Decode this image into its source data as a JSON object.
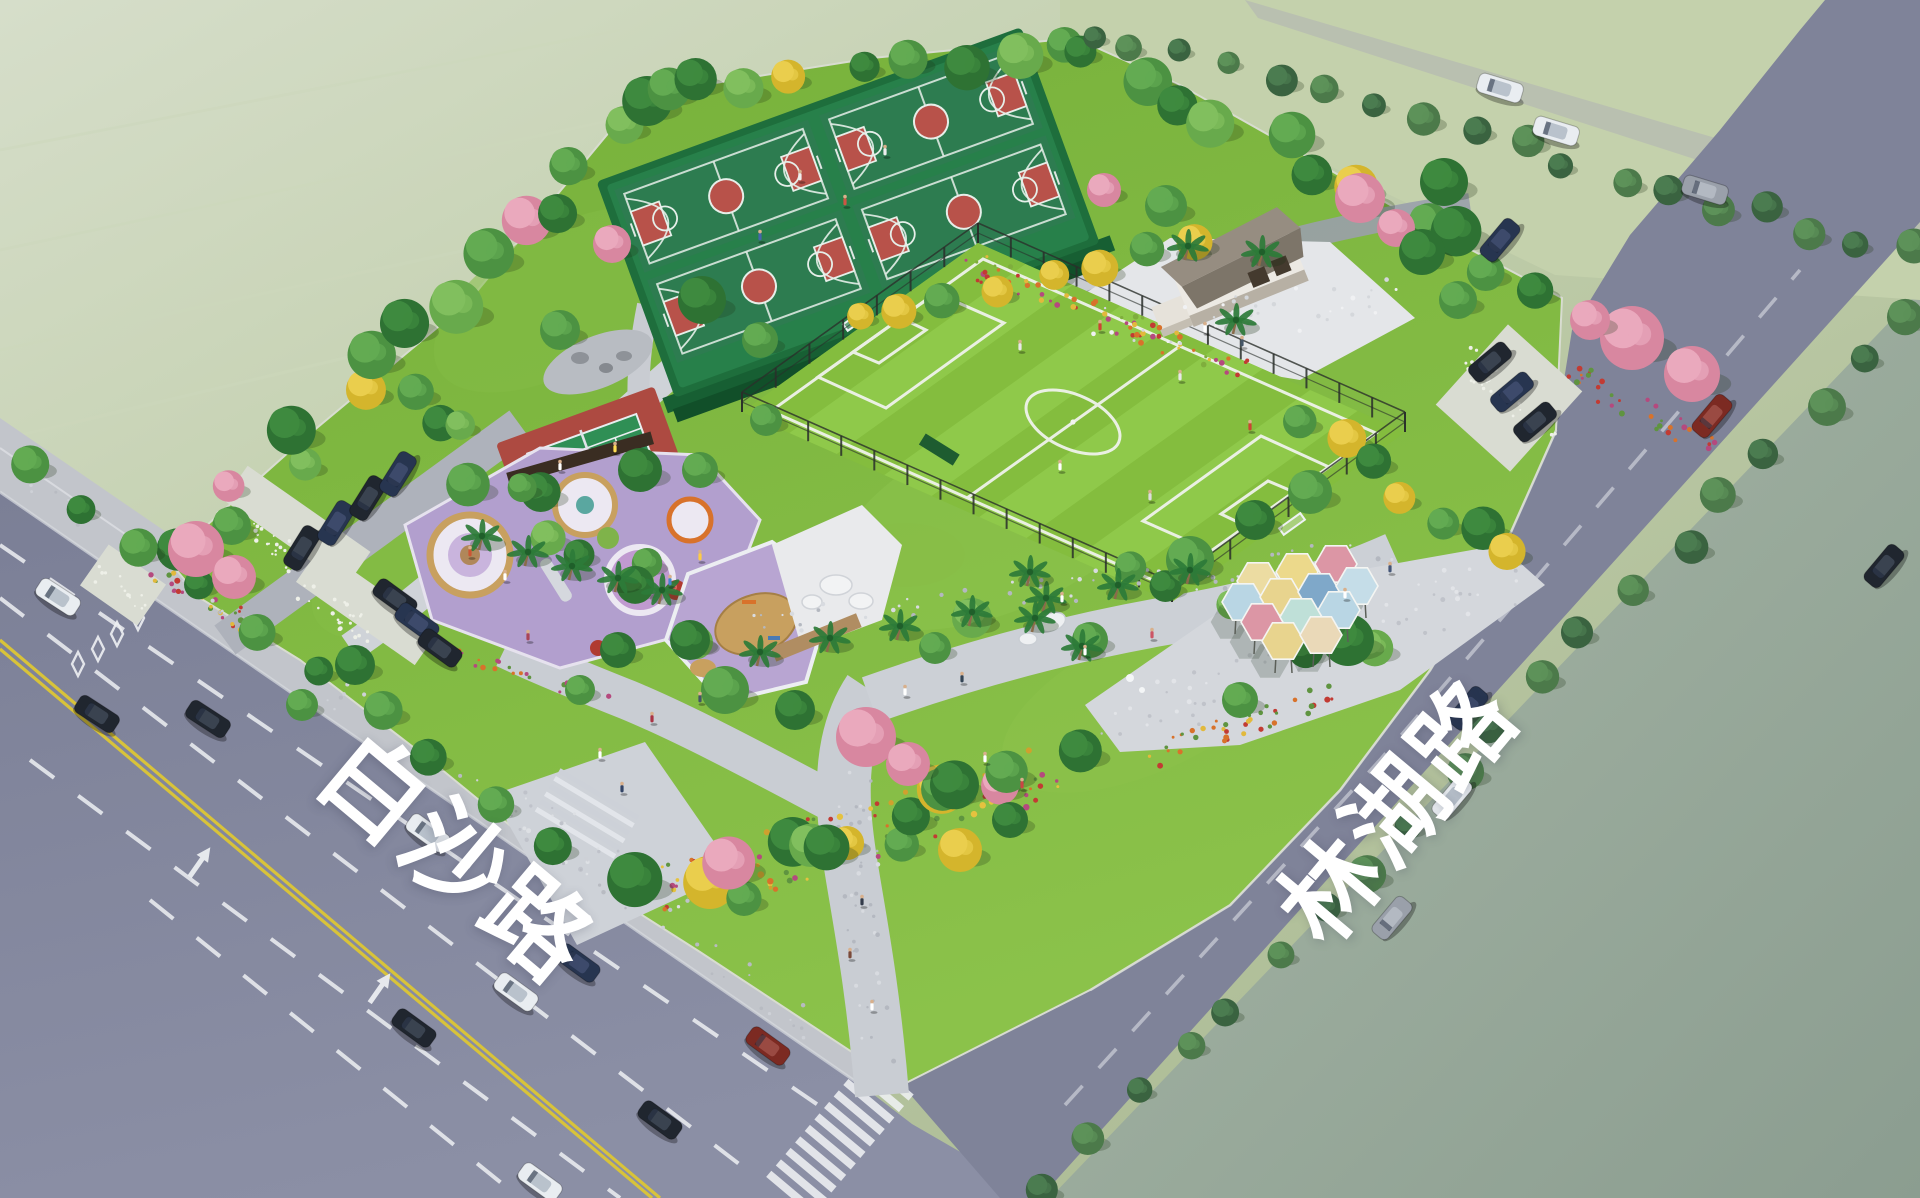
{
  "meta": {
    "type": "aerial-landscape-render",
    "subject": "community sports park at the corner of two roads",
    "canvas": {
      "w": 1920,
      "h": 1198
    }
  },
  "labels": {
    "road_bottom": "白沙路",
    "road_right": "林湖路",
    "text_color": "#ffffff"
  },
  "palette": {
    "road": "#7e8299",
    "road_light": "#8d91a6",
    "sidewalk": "#c2c5cb",
    "park_lawn": "#7cb43e",
    "lawn_light": "#8dc44e",
    "football_green": "#84bd3e",
    "football_stripe": "#90c94b",
    "court_green": "#2d7c50",
    "court_red": "#b8524a",
    "tennis_red": "#ad4a41",
    "tennis_green": "#2f8f55",
    "path_gray": "#c9cdd3",
    "plaza_white": "#e4e6e9",
    "play_purple": "#b29fce",
    "sand_tan": "#c8a05f",
    "hedge_dark": "#1e6e3c",
    "haze_field": "#c2cfad",
    "river": "#93a496",
    "marking_white": "#eef0f3",
    "marking_yellow": "#d8c33a"
  },
  "facilities": {
    "basketball_courts": 4,
    "tennis_courts": 1,
    "football_fields": 1,
    "children_playground": 1,
    "sand_play_area": 1,
    "hexagon_canopy_plaza": 1,
    "pavilion_buildings": 1,
    "parking_clusters": 2,
    "zebra_crossings": 1
  },
  "hex_canopies": {
    "cx": 1290,
    "cy": 610,
    "r": 21,
    "items": [
      {
        "dx": -32,
        "dy": -29,
        "c": "#ecdca2"
      },
      {
        "dx": 7,
        "dy": -38,
        "c": "#ecd98b"
      },
      {
        "dx": 46,
        "dy": -46,
        "c": "#dc96a5"
      },
      {
        "dx": -47,
        "dy": -8,
        "c": "#b9d6e4"
      },
      {
        "dx": -9,
        "dy": -13,
        "c": "#e8d48e"
      },
      {
        "dx": 29,
        "dy": -18,
        "c": "#7fa8c9"
      },
      {
        "dx": 67,
        "dy": -24,
        "c": "#c5dde8"
      },
      {
        "dx": -28,
        "dy": 12,
        "c": "#dc96a5"
      },
      {
        "dx": 11,
        "dy": 7,
        "c": "#bfe0d8"
      },
      {
        "dx": 49,
        "dy": 0,
        "c": "#b9d6e4"
      },
      {
        "dx": -7,
        "dy": 31,
        "c": "#e8d48e"
      },
      {
        "dx": 31,
        "dy": 25,
        "c": "#ead9b8"
      }
    ]
  },
  "football_corners": {
    "N": [
      978,
      243
    ],
    "E": [
      1405,
      432
    ],
    "S": [
      1172,
      602
    ],
    "W": [
      742,
      412
    ],
    "stripes": 9
  },
  "fence_edges": [
    [
      742,
      412,
      1172,
      602,
      13
    ],
    [
      1172,
      602,
      1405,
      432,
      8
    ],
    [
      978,
      243,
      1405,
      432,
      13
    ],
    [
      742,
      412,
      978,
      243,
      7
    ]
  ],
  "tree_belts": [
    {
      "x1": 185,
      "y1": 555,
      "x2": 635,
      "y2": 105,
      "n": 15,
      "w": 48,
      "rmin": 15,
      "rmax": 27,
      "types": [
        "g_dark",
        "g_mid",
        "pink",
        "g_light",
        "g_dark",
        "yellow",
        "g_mid",
        "g_dark",
        "g_light",
        "g_mid",
        "pink",
        "g_dark",
        "g_mid",
        "g_light",
        "g_dark"
      ]
    },
    {
      "x1": 650,
      "y1": 100,
      "x2": 1070,
      "y2": 45,
      "n": 9,
      "w": 40,
      "rmin": 15,
      "rmax": 24,
      "types": [
        "g_mid",
        "g_dark",
        "g_light",
        "yellow",
        "g_dark",
        "g_mid",
        "g_dark",
        "g_light",
        "g_mid"
      ]
    },
    {
      "x1": 1085,
      "y1": 50,
      "x2": 1550,
      "y2": 292,
      "n": 11,
      "w": 46,
      "rmin": 15,
      "rmax": 26,
      "types": [
        "g_dark",
        "g_mid",
        "g_dark",
        "g_light",
        "g_mid",
        "g_dark",
        "yellow",
        "g_mid",
        "g_dark",
        "g_mid",
        "g_dark"
      ]
    },
    {
      "x1": 1048,
      "y1": 1190,
      "x2": 1905,
      "y2": 318,
      "n": 20,
      "w": 26,
      "rmin": 12,
      "rmax": 19,
      "types": [
        "street",
        "street_l"
      ]
    },
    {
      "x1": 1090,
      "y1": 30,
      "x2": 1910,
      "y2": 255,
      "n": 18,
      "w": 26,
      "rmin": 11,
      "rmax": 18,
      "types": [
        "street",
        "street_l"
      ]
    },
    {
      "x1": 30,
      "y1": 462,
      "x2": 552,
      "y2": 842,
      "n": 10,
      "w": 16,
      "rmin": 14,
      "rmax": 20,
      "types": [
        "g_mid",
        "g_dark"
      ]
    },
    {
      "x1": 858,
      "y1": 322,
      "x2": 1185,
      "y2": 240,
      "n": 8,
      "w": 20,
      "rmin": 13,
      "rmax": 19,
      "types": [
        "yellow",
        "yellow",
        "g_mid",
        "yellow"
      ]
    },
    {
      "x1": 1290,
      "y1": 428,
      "x2": 1525,
      "y2": 556,
      "n": 7,
      "w": 36,
      "rmin": 14,
      "rmax": 22,
      "types": [
        "g_mid",
        "yellow",
        "g_dark",
        "yellow",
        "g_mid",
        "g_dark",
        "yellow"
      ]
    },
    {
      "x1": 665,
      "y1": 898,
      "x2": 1060,
      "y2": 762,
      "n": 16,
      "w": 62,
      "rmin": 15,
      "rmax": 28,
      "types": [
        "g_dark",
        "yellow",
        "g_mid",
        "pink",
        "g_dark",
        "g_light",
        "yellow",
        "g_dark",
        "g_mid",
        "g_dark",
        "yellow",
        "g_mid",
        "g_dark",
        "pink",
        "g_mid",
        "g_dark"
      ]
    },
    {
      "x1": 400,
      "y1": 395,
      "x2": 680,
      "y2": 620,
      "n": 11,
      "w": 64,
      "rmin": 14,
      "rmax": 24,
      "types": [
        "g_mid",
        "g_dark",
        "g_light",
        "g_mid",
        "g_dark",
        "g_mid",
        "g_light",
        "g_dark",
        "g_mid",
        "g_dark",
        "g_light"
      ]
    },
    {
      "x1": 1110,
      "y1": 565,
      "x2": 1360,
      "y2": 655,
      "n": 6,
      "w": 44,
      "rmin": 14,
      "rmax": 22,
      "types": [
        "g_mid",
        "g_dark",
        "g_light"
      ]
    }
  ],
  "tree_singles": [
    [
      196,
      549,
      28,
      "pink"
    ],
    [
      234,
      577,
      22,
      "pink"
    ],
    [
      1632,
      338,
      32,
      "pink"
    ],
    [
      1692,
      374,
      28,
      "pink"
    ],
    [
      1590,
      320,
      20,
      "pink"
    ],
    [
      866,
      737,
      30,
      "pink"
    ],
    [
      908,
      764,
      22,
      "pink"
    ],
    [
      612,
      244,
      19,
      "pink"
    ],
    [
      1360,
      198,
      25,
      "pink"
    ],
    [
      1396,
      228,
      19,
      "pink"
    ],
    [
      1104,
      190,
      17,
      "pink"
    ],
    [
      1166,
      206,
      21,
      "g_mid"
    ],
    [
      1422,
      252,
      23,
      "g_dark"
    ],
    [
      1458,
      300,
      19,
      "g_mid"
    ],
    [
      1444,
      182,
      24,
      "g_dark"
    ],
    [
      702,
      300,
      24,
      "g_dark"
    ],
    [
      760,
      340,
      18,
      "g_mid"
    ],
    [
      560,
      330,
      20,
      "g_mid"
    ],
    [
      640,
      470,
      22,
      "g_dark"
    ],
    [
      700,
      470,
      18,
      "g_mid"
    ],
    [
      355,
      665,
      20,
      "g_dark"
    ],
    [
      302,
      705,
      16,
      "g_mid"
    ],
    [
      1190,
      560,
      24,
      "g_mid"
    ],
    [
      1255,
      520,
      20,
      "g_dark"
    ],
    [
      1310,
      492,
      22,
      "g_mid"
    ],
    [
      1348,
      640,
      26,
      "g_dark"
    ],
    [
      1240,
      700,
      18,
      "g_mid"
    ],
    [
      972,
      618,
      20,
      "g_light"
    ],
    [
      935,
      648,
      16,
      "g_mid"
    ],
    [
      618,
      650,
      18,
      "g_dark"
    ],
    [
      580,
      690,
      15,
      "g_mid"
    ],
    [
      766,
      420,
      16,
      "g_mid"
    ],
    [
      690,
      640,
      20,
      "g_dark"
    ],
    [
      725,
      690,
      24,
      "g_mid"
    ],
    [
      795,
      710,
      20,
      "g_dark"
    ],
    [
      960,
      850,
      22,
      "yellow"
    ],
    [
      1010,
      820,
      18,
      "g_dark"
    ],
    [
      1090,
      640,
      18,
      "g_mid"
    ]
  ],
  "palms": [
    [
      482,
      536
    ],
    [
      528,
      552
    ],
    [
      572,
      566
    ],
    [
      618,
      578
    ],
    [
      662,
      590
    ],
    [
      760,
      652
    ],
    [
      830,
      638
    ],
    [
      900,
      626
    ],
    [
      972,
      612
    ],
    [
      1046,
      598
    ],
    [
      1118,
      585
    ],
    [
      1190,
      570
    ],
    [
      1188,
      246
    ],
    [
      1262,
      252
    ],
    [
      1236,
      320
    ],
    [
      1035,
      618
    ],
    [
      1082,
      646
    ],
    [
      1030,
      572
    ]
  ],
  "cars": {
    "colors": {
      "white": "#e9edf1",
      "black": "#20262f",
      "navy": "#273550",
      "gray": "#9aa0aa",
      "darkred": "#7c2a22"
    },
    "cabins": {
      "white": "#b9c2cc",
      "black": "#3a4350",
      "navy": "#3d4a6b",
      "gray": "#b3b9c2",
      "darkred": "#9a4a42"
    },
    "items": [
      [
        428,
        833,
        36,
        "white"
      ],
      [
        578,
        963,
        36,
        "navy"
      ],
      [
        516,
        992,
        36,
        "white"
      ],
      [
        414,
        1028,
        36,
        "black"
      ],
      [
        97,
        714,
        33,
        "black"
      ],
      [
        208,
        719,
        33,
        "black"
      ],
      [
        58,
        597,
        33,
        "white"
      ],
      [
        768,
        1046,
        36,
        "darkred"
      ],
      [
        660,
        1120,
        36,
        "black"
      ],
      [
        540,
        1182,
        36,
        "white"
      ],
      [
        1468,
        708,
        -50,
        "navy"
      ],
      [
        1452,
        798,
        -50,
        "white"
      ],
      [
        1392,
        918,
        -50,
        "gray"
      ],
      [
        1712,
        416,
        -50,
        "darkred"
      ],
      [
        1500,
        240,
        -50,
        "navy"
      ],
      [
        1884,
        566,
        -50,
        "black"
      ],
      [
        1500,
        88,
        17,
        "white"
      ],
      [
        1556,
        131,
        17,
        "white"
      ],
      [
        1705,
        190,
        17,
        "gray"
      ],
      [
        302,
        548,
        -58,
        "black"
      ],
      [
        336,
        523,
        -58,
        "navy"
      ],
      [
        368,
        498,
        -58,
        "black"
      ],
      [
        398,
        474,
        -58,
        "navy"
      ],
      [
        395,
        598,
        36,
        "black"
      ],
      [
        417,
        622,
        36,
        "navy"
      ],
      [
        440,
        648,
        36,
        "black"
      ],
      [
        1490,
        362,
        -40,
        "black"
      ],
      [
        1512,
        392,
        -40,
        "navy"
      ],
      [
        1535,
        422,
        -40,
        "black"
      ]
    ]
  },
  "people": [
    [
      1020,
      350,
      "#e8e8e8"
    ],
    [
      1100,
      330,
      "#cc4433"
    ],
    [
      1180,
      380,
      "#e8e8e8"
    ],
    [
      1250,
      430,
      "#cc4433"
    ],
    [
      1060,
      470,
      "#ffffff"
    ],
    [
      1150,
      500,
      "#dddddd"
    ],
    [
      800,
      180,
      "#eeeeee"
    ],
    [
      845,
      205,
      "#cc5544"
    ],
    [
      885,
      155,
      "#eeeeee"
    ],
    [
      760,
      240,
      "#4466aa"
    ],
    [
      862,
      905,
      "#333b4a"
    ],
    [
      850,
      958,
      "#7a4a3a"
    ],
    [
      872,
      1010,
      "#ffffff"
    ],
    [
      700,
      702,
      "#445566"
    ],
    [
      652,
      722,
      "#aa3344"
    ],
    [
      905,
      695,
      "#ffffff"
    ],
    [
      962,
      682,
      "#334455"
    ],
    [
      1085,
      655,
      "#ffffff"
    ],
    [
      1152,
      638,
      "#cc5566"
    ],
    [
      1345,
      598,
      "#ffffff"
    ],
    [
      1390,
      572,
      "#445577"
    ],
    [
      528,
      640,
      "#aa4455"
    ],
    [
      600,
      758,
      "#ffffff"
    ],
    [
      622,
      792,
      "#334466"
    ],
    [
      1205,
      332,
      "#ffffff"
    ],
    [
      1242,
      346,
      "#445566"
    ],
    [
      1062,
      602,
      "#ffffff"
    ],
    [
      1022,
      788,
      "#cc4444"
    ],
    [
      985,
      762,
      "#ffffff"
    ],
    [
      700,
      560,
      "#ffcc44"
    ],
    [
      670,
      585,
      "#4488cc"
    ],
    [
      470,
      556,
      "#cc5533"
    ],
    [
      505,
      580,
      "#ffffff"
    ],
    [
      560,
      470,
      "#ffffff"
    ],
    [
      615,
      452,
      "#ffdd55"
    ]
  ],
  "scatter_beds": [
    {
      "x1": 965,
      "y1": 262,
      "x2": 1245,
      "y2": 372,
      "n": 64,
      "w": 26,
      "r": 2.2,
      "colors": [
        "#c23b33",
        "#d8722b",
        "#e2b93c",
        "#7fae3d",
        "#b5497e"
      ]
    },
    {
      "x1": 660,
      "y1": 895,
      "x2": 1055,
      "y2": 772,
      "n": 90,
      "w": 58,
      "r": 2.4,
      "colors": [
        "#c23b33",
        "#d8722b",
        "#e5c23f",
        "#b5497e",
        "#5f9440",
        "#d0a02e"
      ]
    },
    {
      "x1": 1148,
      "y1": 758,
      "x2": 1342,
      "y2": 692,
      "n": 40,
      "w": 26,
      "r": 2.2,
      "colors": [
        "#c23b33",
        "#d8722b",
        "#e2b93c",
        "#5f9440"
      ]
    },
    {
      "x1": 152,
      "y1": 566,
      "x2": 272,
      "y2": 638,
      "n": 34,
      "w": 24,
      "r": 2.2,
      "colors": [
        "#c23b33",
        "#e2b93c",
        "#b5497e",
        "#5f9440"
      ]
    },
    {
      "x1": 1566,
      "y1": 372,
      "x2": 1716,
      "y2": 446,
      "n": 34,
      "w": 26,
      "r": 2.2,
      "colors": [
        "#c23b33",
        "#d8722b",
        "#b5497e",
        "#5f9440"
      ]
    },
    {
      "x1": 436,
      "y1": 648,
      "x2": 608,
      "y2": 700,
      "n": 22,
      "w": 16,
      "r": 2,
      "colors": [
        "#b5497e",
        "#d8722b",
        "#5f9440"
      ]
    },
    {
      "x1": 222,
      "y1": 508,
      "x2": 298,
      "y2": 562,
      "n": 26,
      "w": 26,
      "r": 1.6,
      "colors": [
        "#eef0e8"
      ]
    },
    {
      "x1": 300,
      "y1": 586,
      "x2": 372,
      "y2": 638,
      "n": 24,
      "w": 26,
      "r": 1.6,
      "colors": [
        "#eef0e8"
      ]
    },
    {
      "x1": 1462,
      "y1": 352,
      "x2": 1548,
      "y2": 442,
      "n": 26,
      "w": 28,
      "r": 1.6,
      "colors": [
        "#eef0e8"
      ]
    },
    {
      "x1": 92,
      "y1": 568,
      "x2": 150,
      "y2": 606,
      "n": 14,
      "w": 20,
      "r": 1.6,
      "colors": [
        "#eef0e8"
      ]
    },
    {
      "x1": 878,
      "y1": 1066,
      "x2": 852,
      "y2": 772,
      "n": 46,
      "w": 38,
      "r": 1.8,
      "colors": [
        "#b4b8c0",
        "#d8dbe0"
      ]
    },
    {
      "x1": 742,
      "y1": 630,
      "x2": 1395,
      "y2": 552,
      "n": 70,
      "w": 34,
      "r": 1.8,
      "colors": [
        "#b4b8c0",
        "#d8dbe0"
      ]
    },
    {
      "x1": 1100,
      "y1": 730,
      "x2": 1520,
      "y2": 572,
      "n": 60,
      "w": 60,
      "r": 1.8,
      "colors": [
        "#c0c3ca",
        "#e2e4e8"
      ]
    },
    {
      "x1": 510,
      "y1": 812,
      "x2": 700,
      "y2": 900,
      "n": 36,
      "w": 56,
      "r": 1.8,
      "colors": [
        "#bfc2ca",
        "#dde0e4"
      ]
    },
    {
      "x1": 1090,
      "y1": 330,
      "x2": 1400,
      "y2": 300,
      "n": 40,
      "w": 46,
      "r": 1.8,
      "colors": [
        "#d4d7db",
        "#f0f1f3"
      ]
    },
    {
      "x1": 20,
      "y1": 470,
      "x2": 860,
      "y2": 1060,
      "n": 50,
      "w": 30,
      "r": 1.6,
      "colors": [
        "#ced1d7",
        "#b8bbc2"
      ]
    }
  ]
}
